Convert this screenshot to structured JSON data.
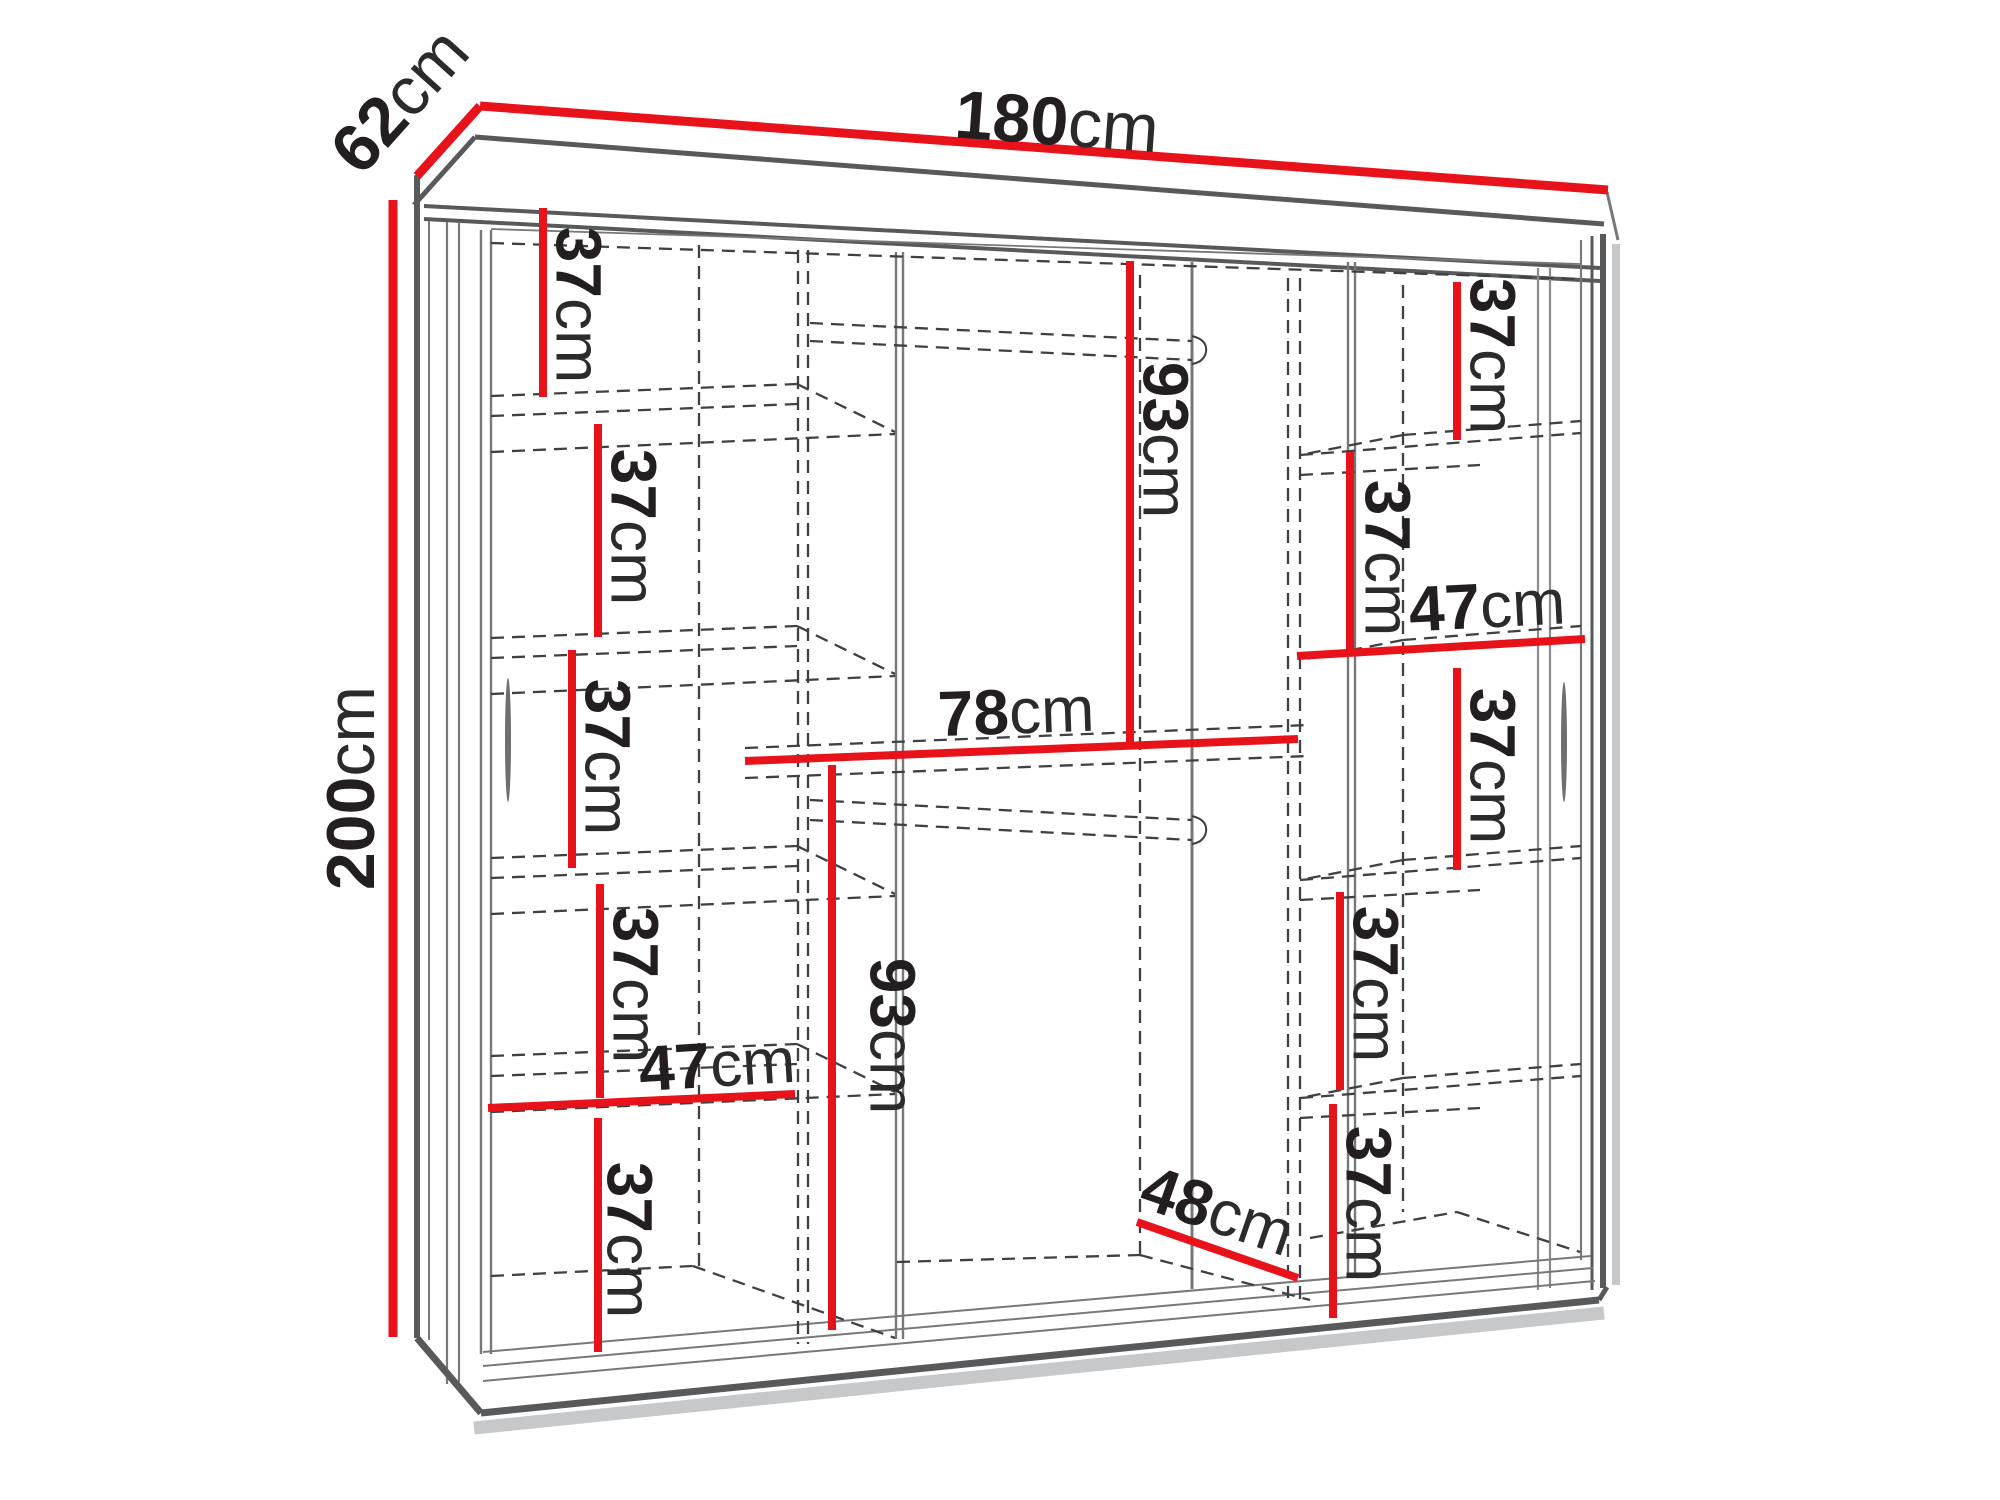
{
  "diagram": {
    "type": "furniture-dimension-diagram",
    "subject": "three-door sliding wardrobe with shelves and hanging rods",
    "overall": {
      "width": {
        "num": "180",
        "unit": "cm"
      },
      "depth": {
        "num": "62",
        "unit": "cm"
      },
      "height": {
        "num": "200",
        "unit": "cm"
      }
    },
    "colors": {
      "dimension_red": "#e8131a",
      "structure_dark": "#58595b",
      "structure_mid": "#77787a",
      "dashed": "#3f4043",
      "shadow": "#c7c8ca",
      "text": "#231f20"
    },
    "labels": [
      {
        "id": "width-180",
        "num": "180",
        "unit": "cm",
        "x": 1057,
        "y": 121,
        "r": 4.2,
        "size": 68
      },
      {
        "id": "depth-62",
        "num": "62",
        "unit": "cm",
        "x": 399,
        "y": 100,
        "r": -48,
        "size": 68
      },
      {
        "id": "height-200",
        "num": "200",
        "unit": "cm",
        "x": 350,
        "y": 788,
        "r": -90,
        "size": 68
      },
      {
        "id": "left-shelf-1-37",
        "num": "37",
        "unit": "cm",
        "x": 579,
        "y": 305,
        "r": 90,
        "size": 64
      },
      {
        "id": "left-shelf-2-37",
        "num": "37",
        "unit": "cm",
        "x": 634,
        "y": 527,
        "r": 90,
        "size": 64
      },
      {
        "id": "left-shelf-3-37",
        "num": "37",
        "unit": "cm",
        "x": 608,
        "y": 757,
        "r": 90,
        "size": 64
      },
      {
        "id": "left-shelf-4-37",
        "num": "37",
        "unit": "cm",
        "x": 636,
        "y": 985,
        "r": 90,
        "size": 64
      },
      {
        "id": "left-shelf-5-37",
        "num": "37",
        "unit": "cm",
        "x": 630,
        "y": 1240,
        "r": 90,
        "size": 64
      },
      {
        "id": "left-width-47",
        "num": "47",
        "unit": "cm",
        "x": 717,
        "y": 1064,
        "r": -3.5,
        "size": 64
      },
      {
        "id": "center-upper-93",
        "num": "93",
        "unit": "cm",
        "x": 1166,
        "y": 440,
        "r": 90,
        "size": 64
      },
      {
        "id": "center-width-78",
        "num": "78",
        "unit": "cm",
        "x": 1016,
        "y": 711,
        "r": -2,
        "size": 64
      },
      {
        "id": "center-lower-93",
        "num": "93",
        "unit": "cm",
        "x": 893,
        "y": 1036,
        "r": 90,
        "size": 64
      },
      {
        "id": "center-depth-48",
        "num": "48",
        "unit": "cm",
        "x": 1218,
        "y": 1210,
        "r": 19,
        "size": 64
      },
      {
        "id": "right-shelf-1-37",
        "num": "37",
        "unit": "cm",
        "x": 1493,
        "y": 356,
        "r": 90,
        "size": 64
      },
      {
        "id": "right-shelf-2-37",
        "num": "37",
        "unit": "cm",
        "x": 1388,
        "y": 558,
        "r": 90,
        "size": 64
      },
      {
        "id": "right-width-47",
        "num": "47",
        "unit": "cm",
        "x": 1487,
        "y": 605,
        "r": -3,
        "size": 64
      },
      {
        "id": "right-shelf-3-37",
        "num": "37",
        "unit": "cm",
        "x": 1493,
        "y": 766,
        "r": 90,
        "size": 64
      },
      {
        "id": "right-shelf-4-37",
        "num": "37",
        "unit": "cm",
        "x": 1376,
        "y": 984,
        "r": 90,
        "size": 64
      },
      {
        "id": "right-shelf-5-37",
        "num": "37",
        "unit": "cm",
        "x": 1369,
        "y": 1204,
        "r": 90,
        "size": 64
      }
    ]
  }
}
